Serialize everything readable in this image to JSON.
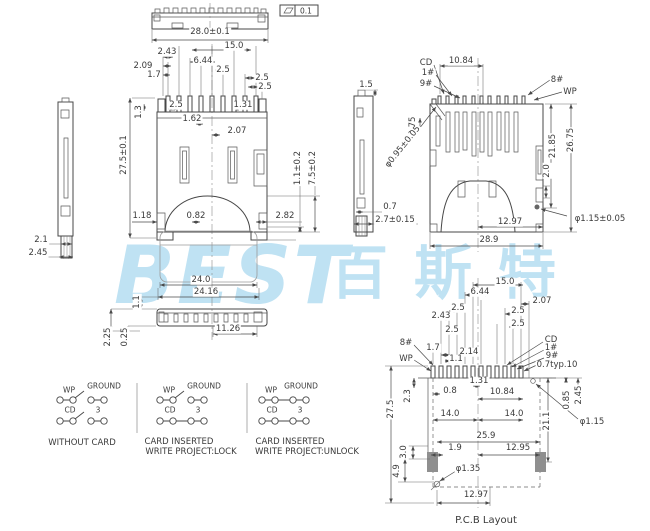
{
  "watermark": {
    "latin": "BEST",
    "cjk": "百斯特",
    "color": "#bfe2f3"
  },
  "flatness": {
    "symbol": "parallelogram-flatness-icon",
    "value": "0.1"
  },
  "top_view": {
    "dims": [
      "28.0±0.1"
    ]
  },
  "front_view": {
    "dims": [
      "15.0",
      "2.43",
      "2.09",
      "1.7",
      "6.44",
      "2.5",
      "2.5",
      "2.5",
      "2.5",
      "1.31",
      "1.3",
      "1.62",
      "2.07",
      "27.5±0.1",
      "1.1±0.2",
      "7.5±0.2",
      "1.18",
      "0.82",
      "2.82"
    ]
  },
  "left_view": {
    "dims": [
      "2.1",
      "2.45"
    ]
  },
  "mid_view": {
    "dims": [
      "1.5",
      "0.7",
      "2.7±0.15"
    ]
  },
  "rear_view": {
    "pins": [
      "CD",
      "1#",
      "9#",
      "8#",
      "WP"
    ],
    "dims": [
      "10.84",
      "0.75",
      "φ0.95±0.05",
      "21.85",
      "26.75",
      "2.0",
      "12.97",
      "28.9",
      "φ1.15±0.05"
    ]
  },
  "bottom_view": {
    "dims": [
      "24.0",
      "24.16",
      "11.26",
      "1.1",
      "2.25",
      "0.25"
    ]
  },
  "switches": [
    {
      "wp": "WP",
      "ground": "GROUND",
      "cd": "CD",
      "three": "3",
      "line1": "WITHOUT CARD"
    },
    {
      "wp": "WP",
      "ground": "GROUND",
      "cd": "CD",
      "three": "3",
      "line1": "CARD INSERTED",
      "line2": "WRITE PROJECT:LOCK"
    },
    {
      "wp": "WP",
      "ground": "GROUND",
      "cd": "CD",
      "three": "3",
      "line1": "CARD INSERTED",
      "line2": "WRITE PROJECT:UNLOCK"
    }
  ],
  "pcb": {
    "title": "P.C.B Layout",
    "pins": [
      "8#",
      "WP",
      "CD",
      "1#",
      "9#"
    ],
    "dims": [
      "15.0",
      "6.44",
      "2.07",
      "2.5",
      "2.43",
      "2.5",
      "2.5",
      "2.5",
      "1.7",
      "2.14",
      "1.1",
      "0.7typ.10",
      "1.31",
      "0.8",
      "10.84",
      "2.3",
      "0.85",
      "2.45",
      "14.0",
      "14.0",
      "21.1",
      "φ1.15",
      "25.9",
      "1.9",
      "12.95",
      "3.0",
      "4.9",
      "φ1.35",
      "12.97",
      "27.5"
    ]
  }
}
